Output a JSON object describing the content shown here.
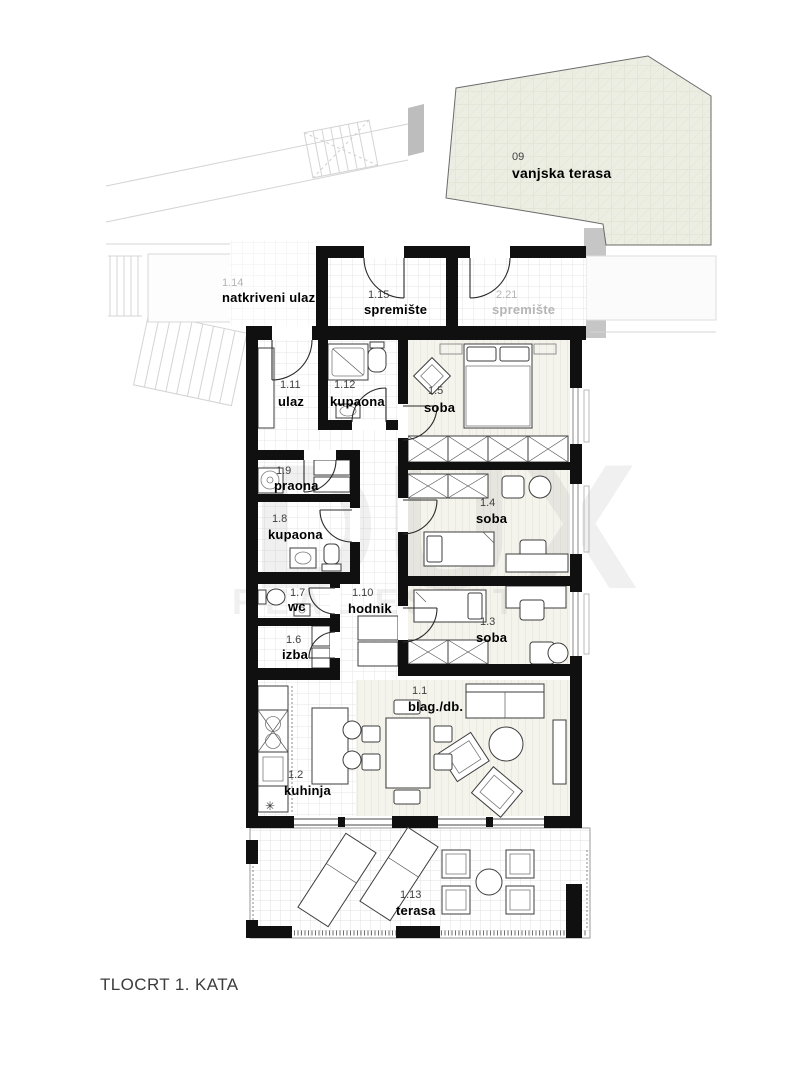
{
  "title": "TLOCRT 1. KATA",
  "watermark": {
    "brand": "DUX",
    "tagline": "REAL ESTATE"
  },
  "colors": {
    "wall": "#101010",
    "muted_label": "#b5b5b5",
    "outdoor_fill": "#eceee3",
    "concrete_band": "#c6c6c6",
    "floor_grid_line": "#e3e3e3",
    "floor_stripe": "#e4e2d4"
  },
  "rooms": [
    {
      "number": "09",
      "name": "vanjska terasa"
    },
    {
      "number": "1.14",
      "name": "natkriveni ulaz"
    },
    {
      "number": "1.15",
      "name": "spremište"
    },
    {
      "number": "2.21",
      "name": "spremište"
    },
    {
      "number": "1.11",
      "name": "ulaz"
    },
    {
      "number": "1.12",
      "name": "kupaona"
    },
    {
      "number": "1.5",
      "name": "soba"
    },
    {
      "number": "1.9",
      "name": "praona"
    },
    {
      "number": "1.8",
      "name": "kupaona"
    },
    {
      "number": "1.4",
      "name": "soba"
    },
    {
      "number": "1.7",
      "name": "wc"
    },
    {
      "number": "1.10",
      "name": "hodnik"
    },
    {
      "number": "1.6",
      "name": "izba"
    },
    {
      "number": "1.3",
      "name": "soba"
    },
    {
      "number": "1.1",
      "name": "blag./db."
    },
    {
      "number": "1.2",
      "name": "kuhinja"
    },
    {
      "number": "1.13",
      "name": "terasa"
    }
  ]
}
